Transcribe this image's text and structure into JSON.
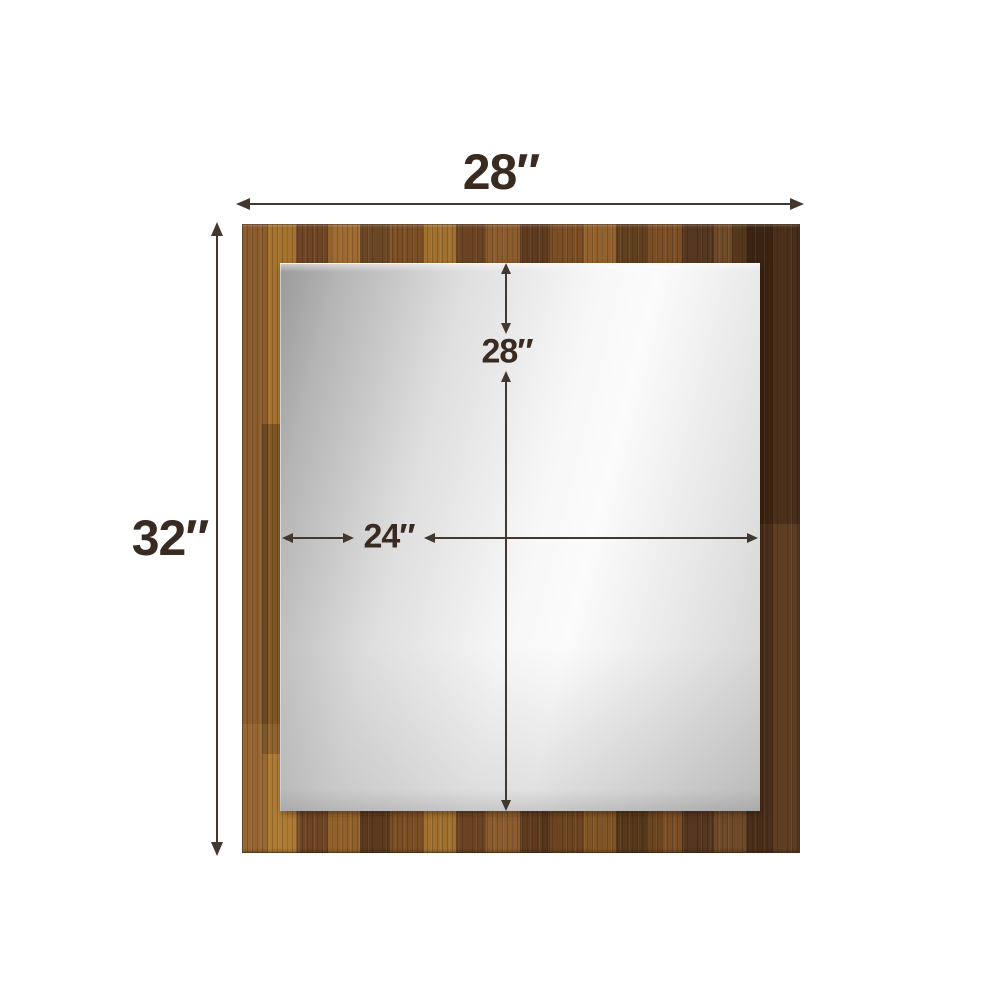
{
  "product_diagram": {
    "subject": "Wood-framed rectangular mirror with dimension annotations",
    "background_color": "#ffffff",
    "dimensions": {
      "overall_width": "28″",
      "overall_height": "32″",
      "mirror_height": "28″",
      "mirror_width": "24″"
    },
    "colors": {
      "label_text": "#3a2b22",
      "dimension_line": "#43382f",
      "wood_light": "#a1722f",
      "wood_medium": "#7b4e26",
      "wood_dark": "#4a2f1b",
      "mirror_edge_gray": "#9a9a9a",
      "mirror_highlight": "#fbfbfb"
    }
  }
}
